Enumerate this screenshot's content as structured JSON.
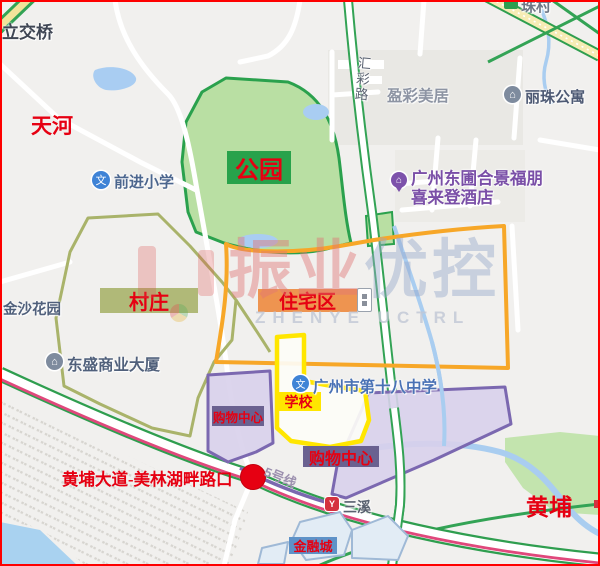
{
  "districts": {
    "tianhe": "天河",
    "huangpu": "黄埔"
  },
  "regions": {
    "park": "公园",
    "village": "村庄",
    "residential": "住宅区",
    "school": "学校",
    "mall_left": "购物中心",
    "mall_right": "购物中心",
    "financial": "金融城"
  },
  "roads": {
    "huicai": "汇彩路",
    "overpass": "立交桥",
    "zhucun": "珠村",
    "metro_line": "5号线"
  },
  "annotation": {
    "intersection": "黄埔大道-美林湖畔路口"
  },
  "pois": {
    "qianjin": "前进小学",
    "yingcai": "盈彩美居",
    "lizhu": "丽珠公寓",
    "hotel1": "广州东圃合景福朋",
    "hotel2": "喜来登酒店",
    "jinsha": "金沙花园",
    "dongsheng": "东盛商业大厦",
    "school18": "广州市第十八中学",
    "sanxi": "三溪"
  },
  "icons": {
    "edu": "文",
    "building": "⌂",
    "metro": "Y"
  },
  "watermark": {
    "cn_red": "振业",
    "cn_blue": "优控",
    "en": "ZHENYE UCTRL"
  },
  "colors": {
    "annotation_red": "#e60012",
    "park_fill": "#b9dfa3",
    "park_border": "#2aa14d",
    "village_border": "#a9b36a",
    "residential_border": "#f7a728",
    "school_border": "#ffe600",
    "mall_fill": "#d8d0eb",
    "mall_border": "#7b68b0",
    "mall_label_bg": "#6a6190",
    "financial_label_bg": "#5e92c8",
    "metro_pink": "#e0487c",
    "road_green": "#33a355",
    "highway_yellow": "#f6ecb4",
    "water": "#a9d2f0",
    "frame_red": "#fe0000"
  }
}
